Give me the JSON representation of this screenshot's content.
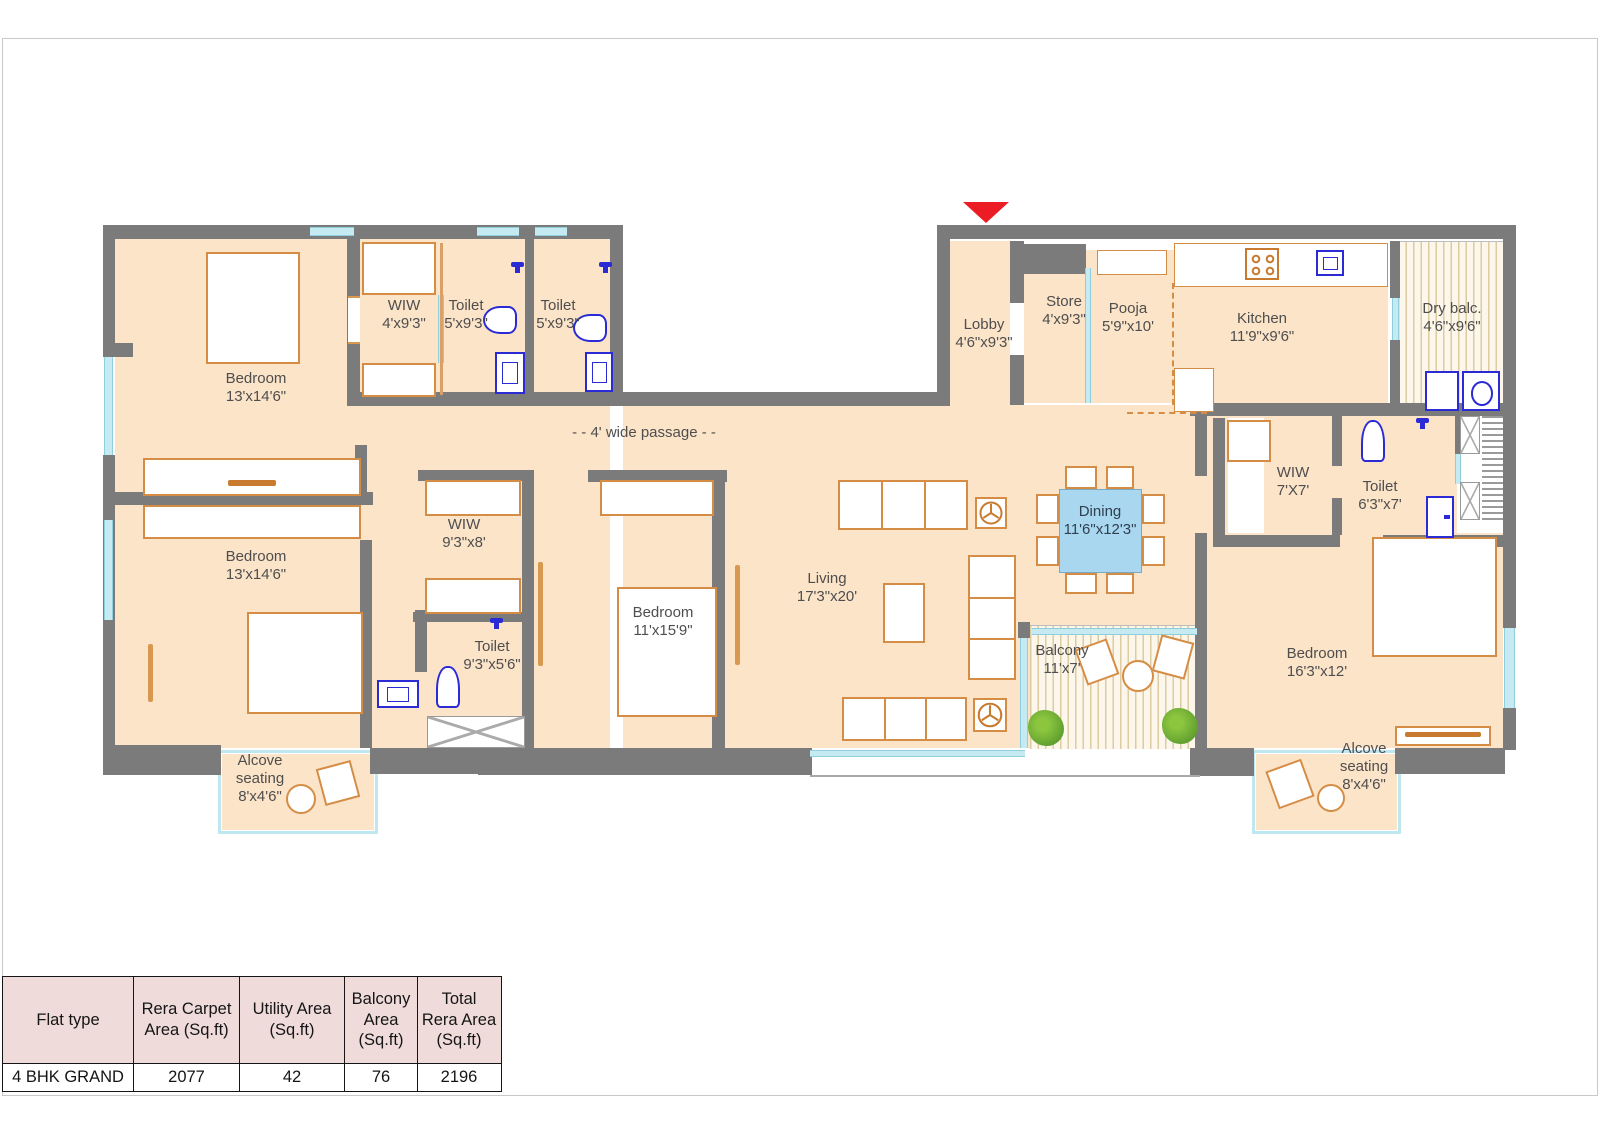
{
  "plan": {
    "passage": {
      "label": "- - 4' wide passage - -"
    },
    "rooms": {
      "bedroom1": {
        "name": "Bedroom",
        "dims": "13'x14'6\""
      },
      "wiw1": {
        "name": "WIW",
        "dims": "4'x9'3\""
      },
      "toilet1": {
        "name": "Toilet",
        "dims": "5'x9'3\""
      },
      "toilet2": {
        "name": "Toilet",
        "dims": "5'x9'3\""
      },
      "lobby": {
        "name": "Lobby",
        "dims": "4'6\"x9'3\""
      },
      "store": {
        "name": "Store",
        "dims": "4'x9'3\""
      },
      "pooja": {
        "name": "Pooja",
        "dims": "5'9\"x10'"
      },
      "kitchen": {
        "name": "Kitchen",
        "dims": "11'9\"x9'6\""
      },
      "drybalc": {
        "name": "Dry balc.",
        "dims": "4'6\"x9'6\""
      },
      "bedroom2": {
        "name": "Bedroom",
        "dims": "13'x14'6\""
      },
      "wiw2": {
        "name": "WIW",
        "dims": "9'3\"x8'"
      },
      "toilet3": {
        "name": "Toilet",
        "dims": "9'3\"x5'6\""
      },
      "bedroom3": {
        "name": "Bedroom",
        "dims": "11'x15'9\""
      },
      "living": {
        "name": "Living",
        "dims": "17'3\"x20'"
      },
      "dining": {
        "name": "Dining",
        "dims": "11'6\"x12'3\""
      },
      "balcony": {
        "name": "Balcony",
        "dims": "11'x7'"
      },
      "wiw3": {
        "name": "WIW",
        "dims": "7'X7'"
      },
      "toilet4": {
        "name": "Toilet",
        "dims": "6'3\"x7'"
      },
      "bedroom4": {
        "name": "Bedroom",
        "dims": "16'3\"x12'"
      },
      "alcove_left": {
        "name": "Alcove seating",
        "dims": "8'x4'6\""
      },
      "alcove_right": {
        "name": "Alcove seating",
        "dims": "8'x4'6\""
      }
    }
  },
  "table": {
    "headers": [
      "Flat type",
      "Rera Carpet Area (Sq.ft)",
      "Utility Area (Sq.ft)",
      "Balcony Area (Sq.ft)",
      "Total Rera Area (Sq.ft)"
    ],
    "rows": [
      [
        "4 BHK GRAND",
        "2077",
        "42",
        "76",
        "2196"
      ]
    ]
  },
  "colors": {
    "wall": "#7b7b7b",
    "room_fill": "#fce4c9",
    "furniture_outline": "#d58d45",
    "fixture_blue": "#2b2bd6",
    "dining_table": "#a9d7ef",
    "window": "#c5eaf2",
    "entrance_red": "#ec1c24",
    "table_header_bg": "#f0dbdb"
  }
}
